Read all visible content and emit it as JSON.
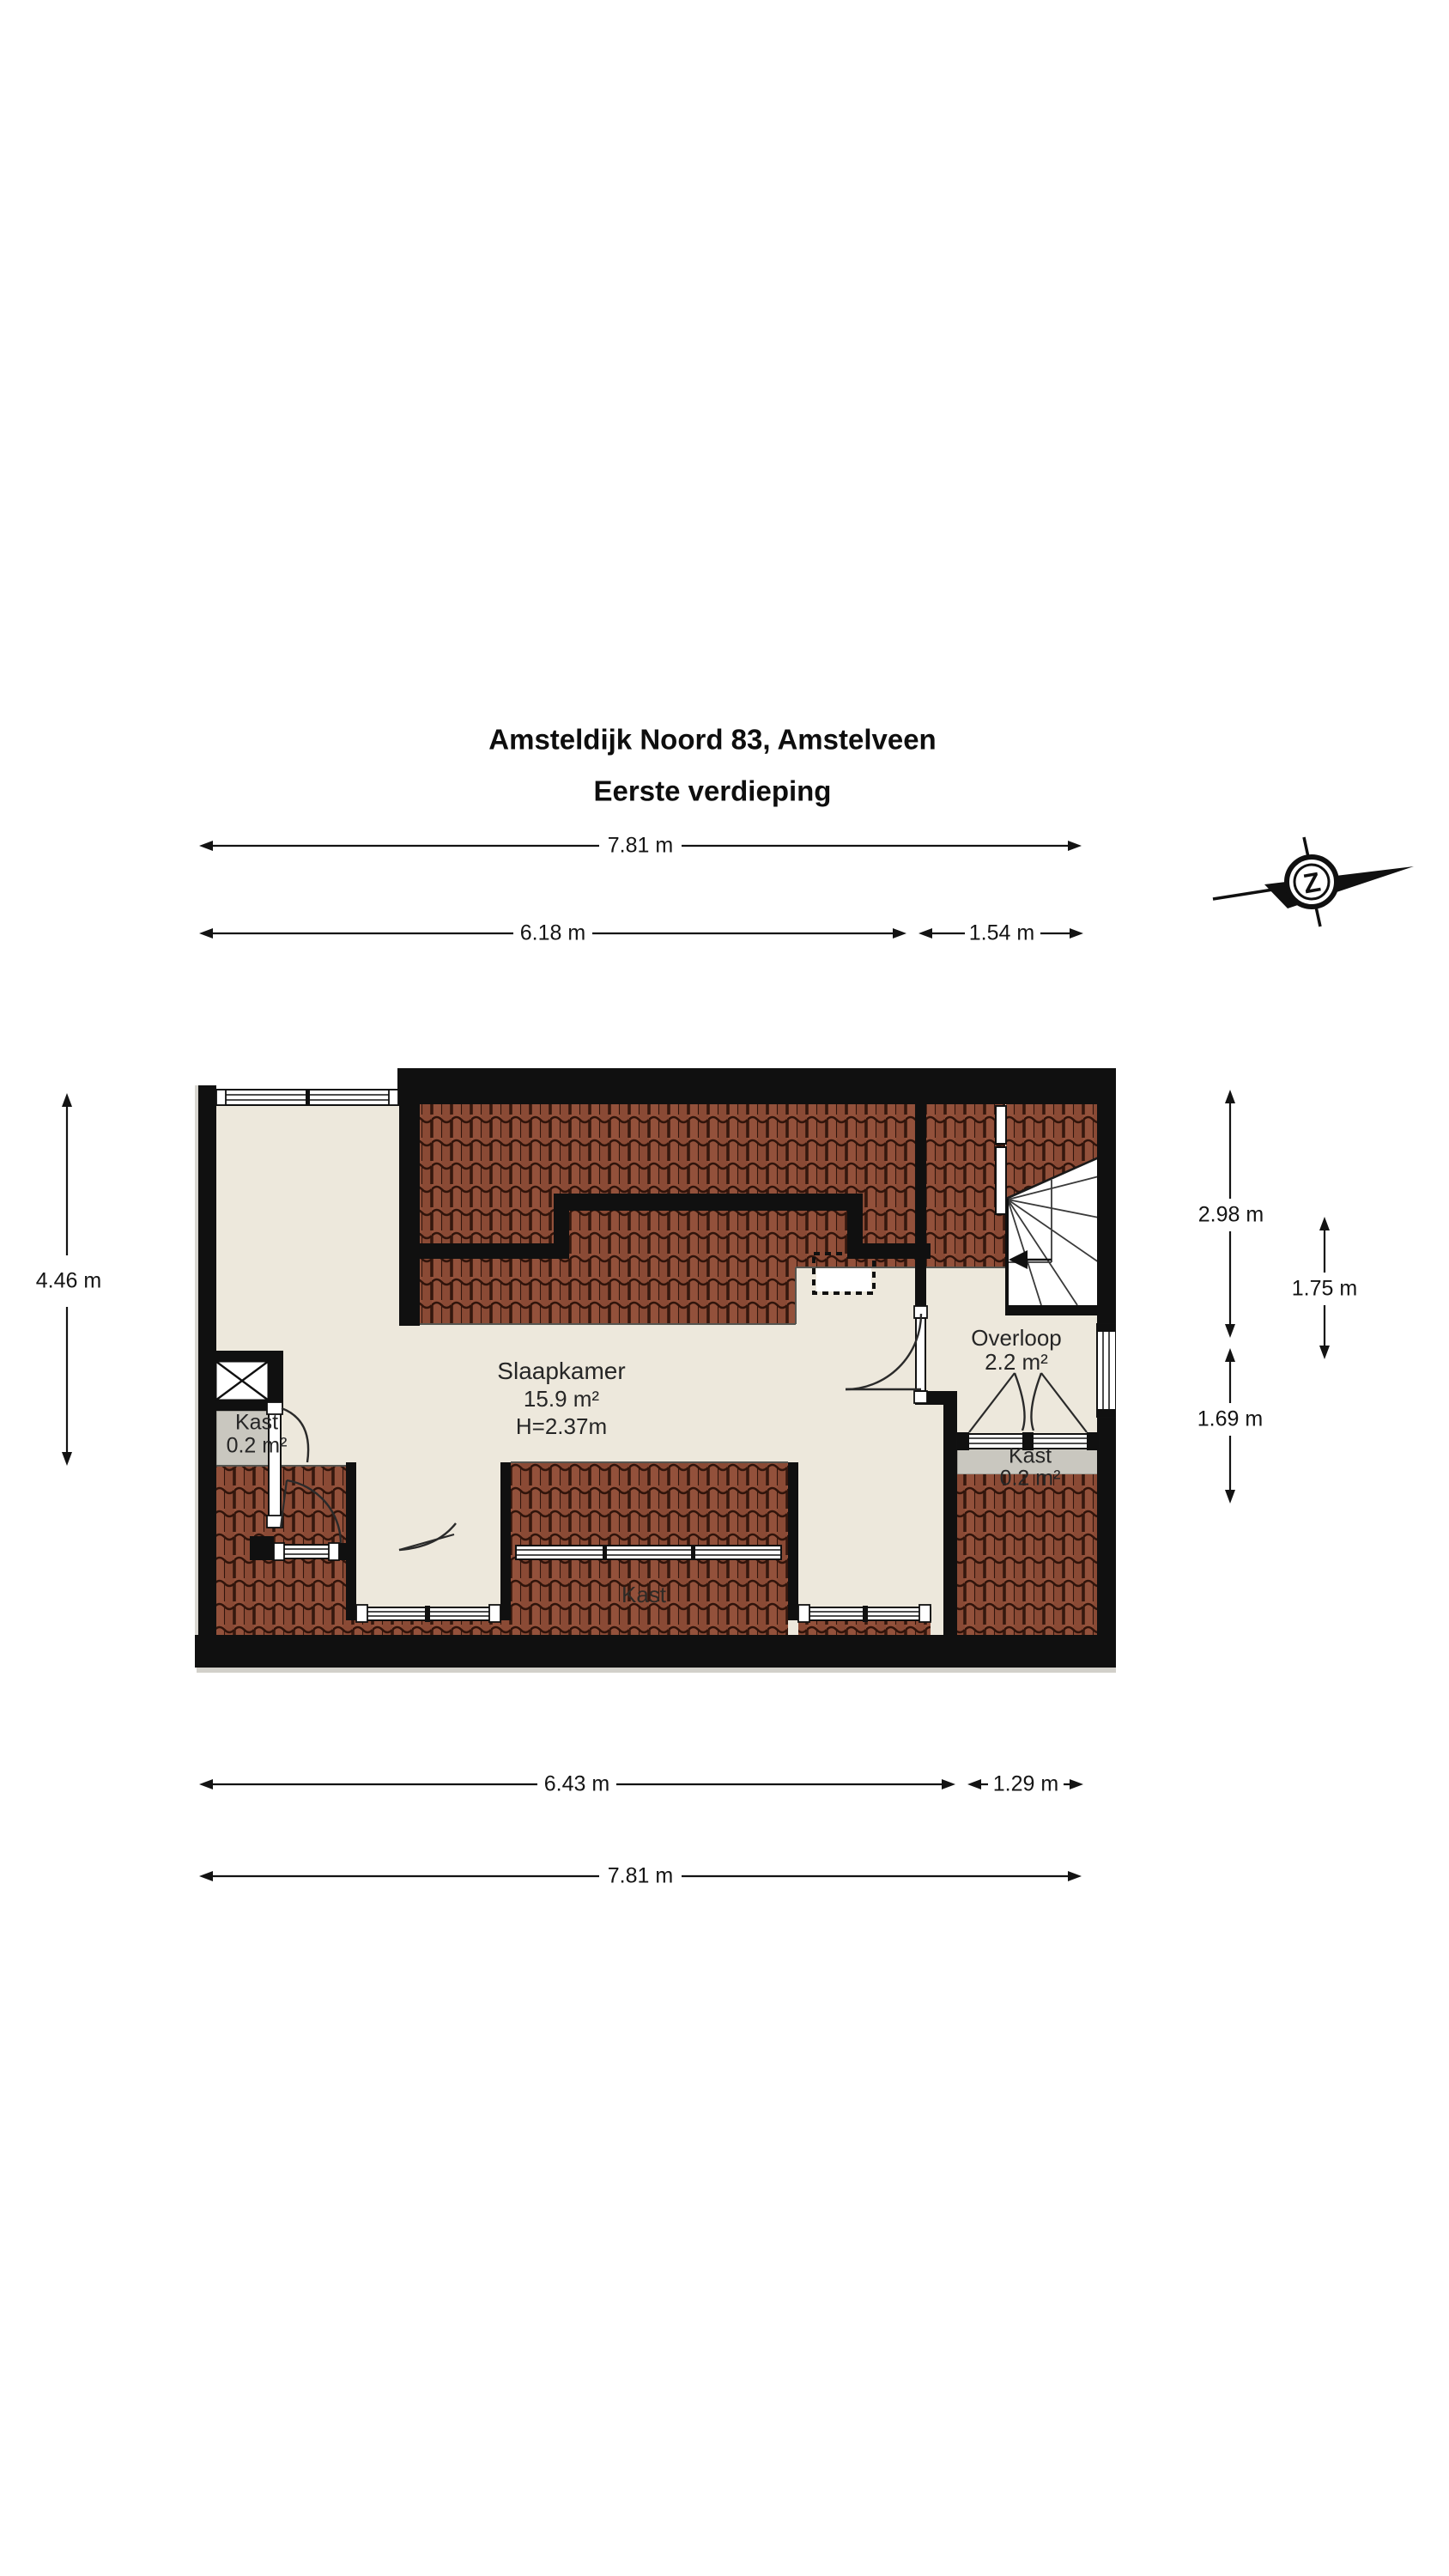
{
  "title": {
    "line1": "Amsteldijk Noord 83, Amstelveen",
    "line2": "Eerste verdieping"
  },
  "compass": {
    "letter": "Z"
  },
  "rooms": {
    "slaapkamer": {
      "name": "Slaapkamer",
      "area": "15.9 m²",
      "height": "H=2.37m"
    },
    "overloop": {
      "name": "Overloop",
      "area": "2.2 m²"
    },
    "kast_left": {
      "name": "Kast",
      "area": "0.2 m²"
    },
    "kast_right": {
      "name": "Kast",
      "area": "0.2 m²"
    },
    "kast_bottom": {
      "name": "Kast"
    }
  },
  "dimensions": {
    "top_full": "7.81 m",
    "top_left": "6.18 m",
    "top_right": "1.54 m",
    "left_height": "4.46 m",
    "right_upper": "2.98 m",
    "right_middle": "1.75 m",
    "right_lower": "1.69 m",
    "bottom_left": "6.43 m",
    "bottom_right": "1.29 m",
    "bottom_full": "7.81 m"
  },
  "colors": {
    "wall": "#101010",
    "floor": "#ede8dc",
    "closet_floor": "#c9c7bf",
    "tile": "#93513b",
    "tile_dark": "#8a4a35",
    "tile_line": "#30140b"
  }
}
